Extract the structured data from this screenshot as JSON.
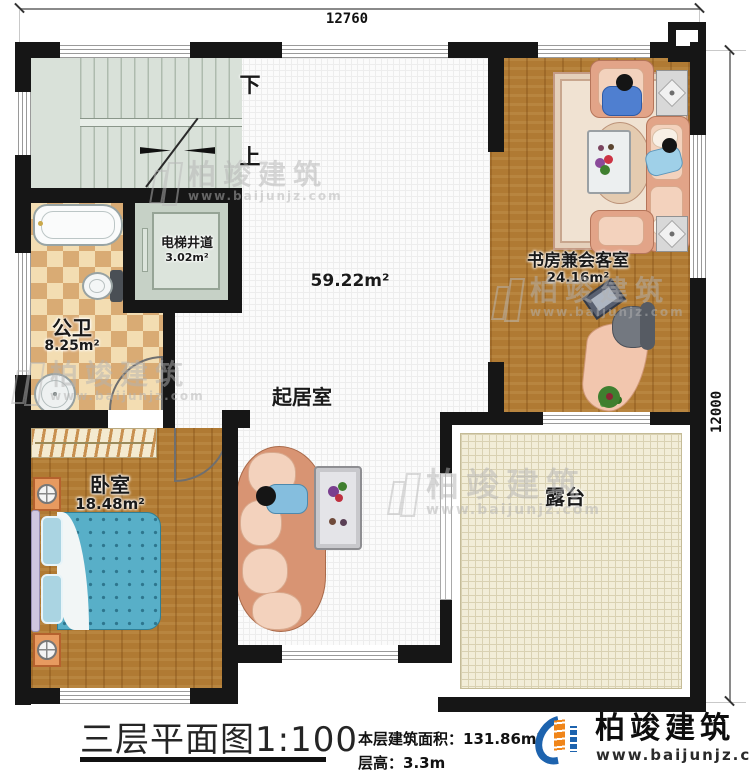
{
  "dimensions": {
    "width_top": "12760",
    "height_right": "12000"
  },
  "stairs": {
    "down": "下",
    "up": "上"
  },
  "rooms": {
    "elevator_shaft": {
      "name": "电梯井道",
      "area": "3.02m²"
    },
    "public_bathroom": {
      "name": "公卫",
      "area": "8.25m²"
    },
    "living_room": {
      "name": "起居室",
      "area": "59.22m²"
    },
    "study_reception": {
      "name": "书房兼会客室",
      "area": "24.16m²"
    },
    "bedroom": {
      "name": "卧室",
      "area": "18.48m²"
    },
    "terrace": {
      "name": "露台"
    }
  },
  "title_block": {
    "title": "三层平面图",
    "scale": "1:100",
    "floor_area_label": "本层建筑面积：",
    "floor_area_value": "131.86m²",
    "floor_height_label": "层高：",
    "floor_height_value": "3.3m"
  },
  "brand": {
    "name": "柏竣建筑",
    "website": "www.baijunjz.com"
  },
  "watermark": {
    "name": "柏竣建筑",
    "website": "www.baijunjz.com"
  },
  "colors": {
    "wall": "#161616",
    "wood": "#b07a33",
    "checker": "#d9ab74",
    "stairs": "#d9e1d9",
    "terrace": "#f2edd8",
    "brand_blue": "#1d63ae",
    "brand_orange": "#f08519"
  }
}
